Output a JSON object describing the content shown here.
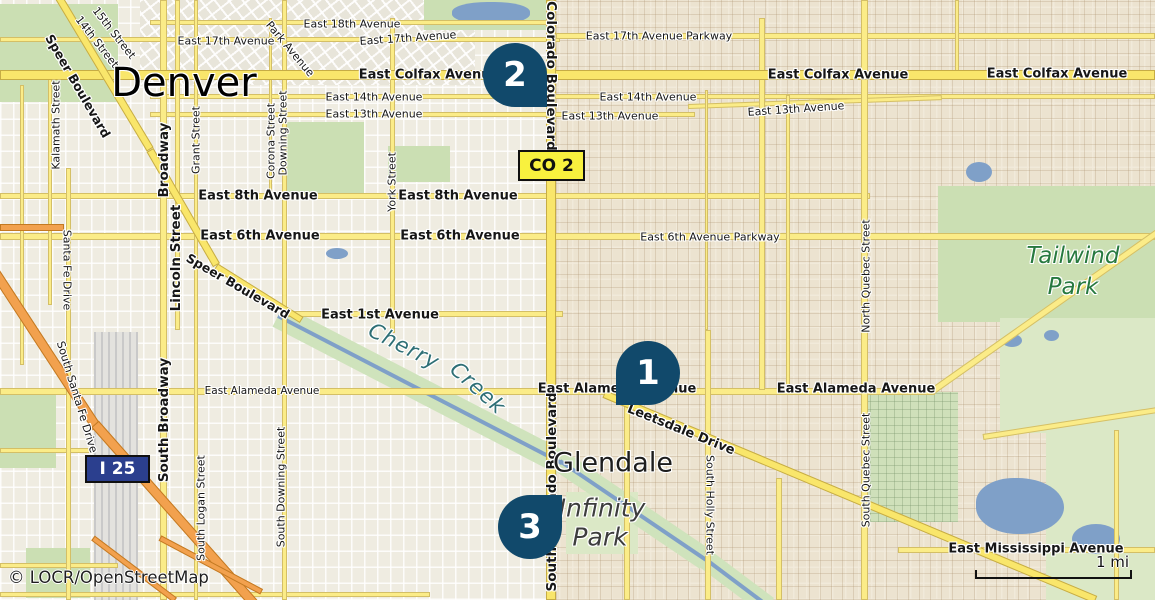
{
  "map": {
    "attribution": "© LOCR/OpenStreetMap",
    "scale": {
      "label": "1 mi"
    },
    "badges": {
      "co2": {
        "text": "CO 2"
      },
      "i25": {
        "text": "I 25"
      }
    },
    "markers": [
      {
        "number": "1",
        "x": 648,
        "y": 373,
        "tail": "bottom-left"
      },
      {
        "number": "2",
        "x": 515,
        "y": 75,
        "tail": "bottom-right"
      },
      {
        "number": "3",
        "x": 530,
        "y": 527,
        "tail": "top-right"
      }
    ],
    "city_label": {
      "text": "Denver",
      "x": 184,
      "y": 83
    },
    "place_labels": [
      {
        "text": "Glendale",
        "x": 613,
        "y": 463,
        "kind": "town"
      },
      {
        "text": "Cherry",
        "x": 404,
        "y": 346,
        "rot": 27,
        "kind": "water"
      },
      {
        "text": "Creek",
        "x": 478,
        "y": 388,
        "rot": 42,
        "kind": "water"
      },
      {
        "text": "Tailwind",
        "x": 1073,
        "y": 256,
        "kind": "park"
      },
      {
        "text": "Park",
        "x": 1073,
        "y": 287,
        "kind": "park"
      },
      {
        "text": "Infinity",
        "x": 602,
        "y": 508,
        "kind": "venue"
      },
      {
        "text": "Park",
        "x": 600,
        "y": 537,
        "kind": "venue"
      }
    ],
    "street_labels": [
      {
        "text": "East 18th Avenue",
        "x": 352,
        "y": 24
      },
      {
        "text": "East 17th Avenue",
        "x": 226,
        "y": 41
      },
      {
        "text": "East 17th Avenue",
        "x": 408,
        "y": 38,
        "rot": -4
      },
      {
        "text": "East 17th Avenue Parkway",
        "x": 659,
        "y": 36
      },
      {
        "text": "East Colfax Avenue",
        "x": 429,
        "y": 75,
        "bold": true,
        "size": 13
      },
      {
        "text": "East Colfax Avenue",
        "x": 838,
        "y": 75,
        "bold": true,
        "size": 13
      },
      {
        "text": "East Colfax Avenue",
        "x": 1057,
        "y": 74,
        "bold": true,
        "size": 13
      },
      {
        "text": "East 14th Avenue",
        "x": 374,
        "y": 97
      },
      {
        "text": "East 14th Avenue",
        "x": 648,
        "y": 97
      },
      {
        "text": "East 13th Avenue",
        "x": 374,
        "y": 114
      },
      {
        "text": "East 13th Avenue",
        "x": 610,
        "y": 116
      },
      {
        "text": "East 13th Avenue",
        "x": 796,
        "y": 109,
        "rot": -4
      },
      {
        "text": "East 8th Avenue",
        "x": 258,
        "y": 196,
        "bold": true,
        "size": 13
      },
      {
        "text": "East 8th Avenue",
        "x": 458,
        "y": 196,
        "bold": true,
        "size": 13
      },
      {
        "text": "East 6th Avenue",
        "x": 260,
        "y": 236,
        "bold": true,
        "size": 13
      },
      {
        "text": "East 6th Avenue",
        "x": 460,
        "y": 236,
        "bold": true,
        "size": 13
      },
      {
        "text": "East 6th Avenue Parkway",
        "x": 710,
        "y": 237
      },
      {
        "text": "East 1st Avenue",
        "x": 380,
        "y": 315,
        "bold": true,
        "size": 13
      },
      {
        "text": "East Alameda Avenue",
        "x": 262,
        "y": 391,
        "size": 10.5
      },
      {
        "text": "East Alameda Avenue",
        "x": 617,
        "y": 389,
        "bold": true,
        "size": 13
      },
      {
        "text": "East Alameda Avenue",
        "x": 856,
        "y": 389,
        "bold": true,
        "size": 13
      },
      {
        "text": "Leetsdale Drive",
        "x": 681,
        "y": 430,
        "rot": 22,
        "bold": true,
        "size": 13
      },
      {
        "text": "East Mississippi Avenue",
        "x": 1036,
        "y": 549,
        "bold": true,
        "size": 13
      },
      {
        "text": "15th Street",
        "x": 114,
        "y": 33,
        "rot": 52
      },
      {
        "text": "14th Street",
        "x": 97,
        "y": 42,
        "rot": 52
      },
      {
        "text": "Park Avenue",
        "x": 290,
        "y": 49,
        "rot": 50
      },
      {
        "text": "Speer Boulevard",
        "x": 78,
        "y": 86,
        "rot": 60,
        "bold": true,
        "size": 12.5
      },
      {
        "text": "Speer Boulevard",
        "x": 238,
        "y": 286,
        "rot": 30,
        "bold": true,
        "size": 12.5
      },
      {
        "text": "Kalamath Street",
        "x": 56,
        "y": 125,
        "rot": -90
      },
      {
        "text": "Santa Fe Drive",
        "x": 67,
        "y": 270,
        "rot": 90
      },
      {
        "text": "South Santa Fe Drive",
        "x": 77,
        "y": 397,
        "rot": 73
      },
      {
        "text": "Broadway",
        "x": 164,
        "y": 160,
        "rot": -90,
        "bold": true,
        "size": 13.5
      },
      {
        "text": "Lincoln Street",
        "x": 176,
        "y": 258,
        "rot": -90,
        "bold": true,
        "size": 13.5
      },
      {
        "text": "Grant Street",
        "x": 196,
        "y": 140,
        "rot": -90
      },
      {
        "text": "South Broadway",
        "x": 164,
        "y": 420,
        "rot": -90,
        "bold": true,
        "size": 13.5
      },
      {
        "text": "South Logan Street",
        "x": 201,
        "y": 508,
        "rot": -90
      },
      {
        "text": "South Downing Street",
        "x": 281,
        "y": 487,
        "rot": -90
      },
      {
        "text": "Downing Street",
        "x": 283,
        "y": 133,
        "rot": -90
      },
      {
        "text": "Corona Street",
        "x": 271,
        "y": 141,
        "rot": -90
      },
      {
        "text": "York Street",
        "x": 392,
        "y": 182,
        "rot": -90
      },
      {
        "text": "Colorado Boulevard",
        "x": 551,
        "y": 76,
        "rot": 90,
        "bold": true,
        "size": 13.5
      },
      {
        "text": "South Colorado Boulevard",
        "x": 552,
        "y": 492,
        "rot": -90,
        "bold": true,
        "size": 13.5
      },
      {
        "text": "South Holly Street",
        "x": 710,
        "y": 505,
        "rot": 90
      },
      {
        "text": "North Quebec Street",
        "x": 866,
        "y": 276,
        "rot": -90
      },
      {
        "text": "South Quebec Street",
        "x": 866,
        "y": 470,
        "rot": -90
      }
    ],
    "colors": {
      "marker": "#11496b",
      "road": "#fbec88",
      "road_major": "#f9e66b",
      "motorway": "#f2a14e",
      "park": "#cbdfb3",
      "golf": "#dbe8c6",
      "water": "#7fa0c8",
      "badge_co2": "#f8f13e",
      "badge_i25": "#2b3f8e",
      "park_label": "#27793f",
      "water_label": "#2e6f75"
    }
  }
}
